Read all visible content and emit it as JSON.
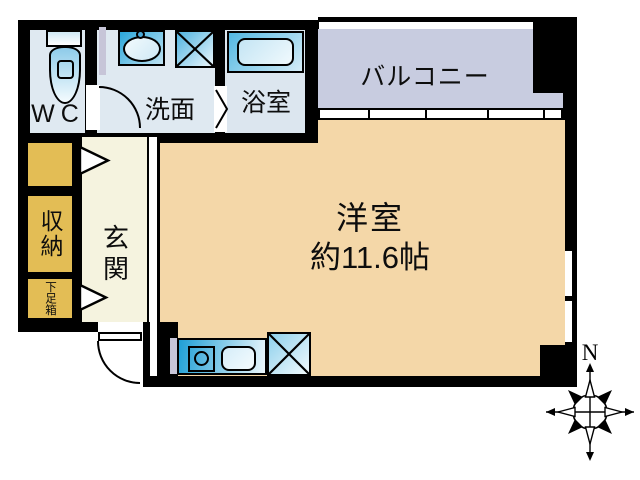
{
  "plan": {
    "rooms": {
      "wc": "WC",
      "washroom": "洗面",
      "bathroom": "浴室",
      "balcony": "バルコニー",
      "storage": "収納",
      "shoe_box": "下足箱",
      "entrance": "玄関",
      "western_room": "洋室",
      "western_room_size": "約11.6帖"
    },
    "compass": {
      "north": "N"
    },
    "fixtures": [
      "toilet",
      "wash-basin",
      "washing-machine-pan",
      "bathtub",
      "gas-stove",
      "kitchen-sink",
      "refrigerator-space",
      "sliding-window",
      "entrance-door",
      "washroom-door",
      "bathroom-folding-door"
    ],
    "colors": {
      "wall": "#000000",
      "western_room_floor": "#f4d7a8",
      "balcony_floor": "#c8cce0",
      "sanitary_floor": "#dfe9f1",
      "storage_fill": "#e3bd55",
      "entrance_floor": "#f5f3df",
      "fixture_blue": "#2aa7db",
      "partition_gray": "#c7c5d8"
    }
  }
}
